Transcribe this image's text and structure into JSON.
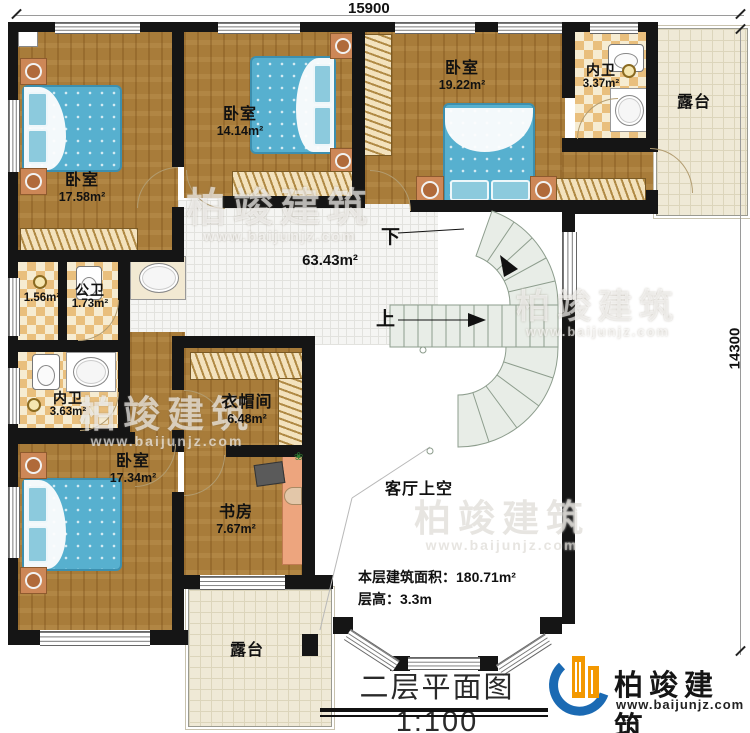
{
  "dimensions": {
    "top": "15900",
    "right": "14300"
  },
  "stairs": {
    "down": "下",
    "up": "上"
  },
  "rooms": {
    "bedroom_tl": {
      "label": "卧室",
      "area": "17.58m²"
    },
    "bedroom_tm": {
      "label": "卧室",
      "area": "14.14m²"
    },
    "bedroom_tr": {
      "label": "卧室",
      "area": "19.22m²"
    },
    "bath_tr": {
      "label": "内卫",
      "area": "3.37m²"
    },
    "terrace_tr": {
      "label": "露台"
    },
    "hall": {
      "area": "63.43m²"
    },
    "store": {
      "area": "1.56m²"
    },
    "bath_public": {
      "label": "公卫",
      "area": "1.73m²"
    },
    "bath_left": {
      "label": "内卫",
      "area": "3.63m²"
    },
    "bedroom_bl": {
      "label": "卧室",
      "area": "17.34m²"
    },
    "cloakroom": {
      "label": "衣帽间",
      "area": "6.48m²"
    },
    "study": {
      "label": "书房",
      "area": "7.67m²"
    },
    "void": {
      "label": "客厅上空"
    },
    "terrace_b": {
      "label": "露台"
    }
  },
  "info": {
    "floor_area": "本层建筑面积：180.71m²",
    "floor_height": "层高：3.3m"
  },
  "title": {
    "text": "二层平面图",
    "scale": "1:100"
  },
  "logo": {
    "name": "柏竣建筑",
    "url": "www.baijunjz.com"
  },
  "watermark": {
    "name": "柏竣建筑",
    "url": "www.baijunjz.com"
  },
  "colors": {
    "wall": "#151515",
    "wood_floor": "#a87c3a",
    "checker_tile": "#e9bf7d",
    "bed": "#57b0cf",
    "stair": "#e8ede7",
    "logo_blue": "#1b6ab3",
    "logo_orange": "#f39800"
  }
}
